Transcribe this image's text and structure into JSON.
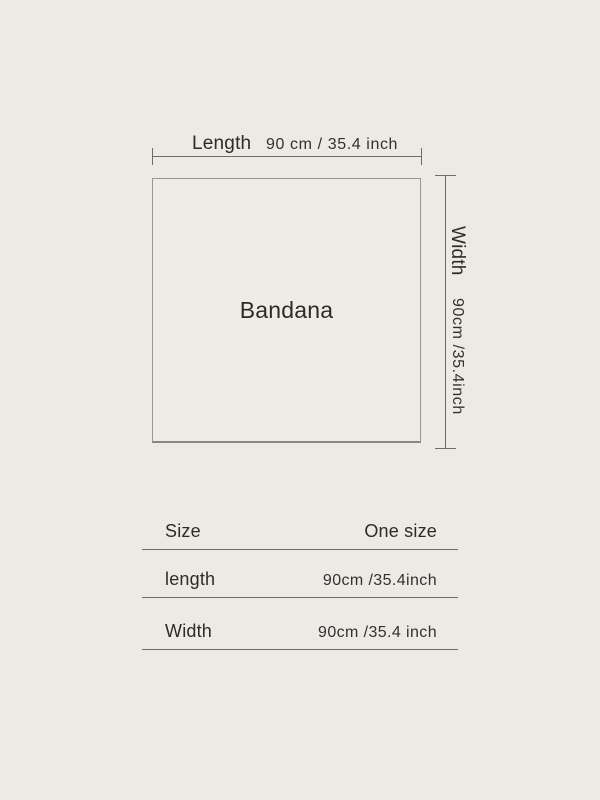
{
  "colors": {
    "background": "#EDE9E5",
    "panel": "#EFECE7",
    "border": "#9A958E",
    "border_dark": "#8A857E",
    "line": "#6F6B65",
    "table_line": "#6C6862",
    "text": "#2D2B28"
  },
  "diagram": {
    "product_label": "Bandana",
    "length_measure": {
      "label": "Length",
      "value": "90 cm / 35.4 inch"
    },
    "width_measure": {
      "label": "Width",
      "value": "90cm /35.4inch"
    }
  },
  "size_table": {
    "rows": [
      {
        "label": "Size",
        "value": "One size"
      },
      {
        "label": "length",
        "value": "90cm /35.4inch"
      },
      {
        "label": "Width",
        "value": "90cm /35.4 inch"
      }
    ]
  }
}
